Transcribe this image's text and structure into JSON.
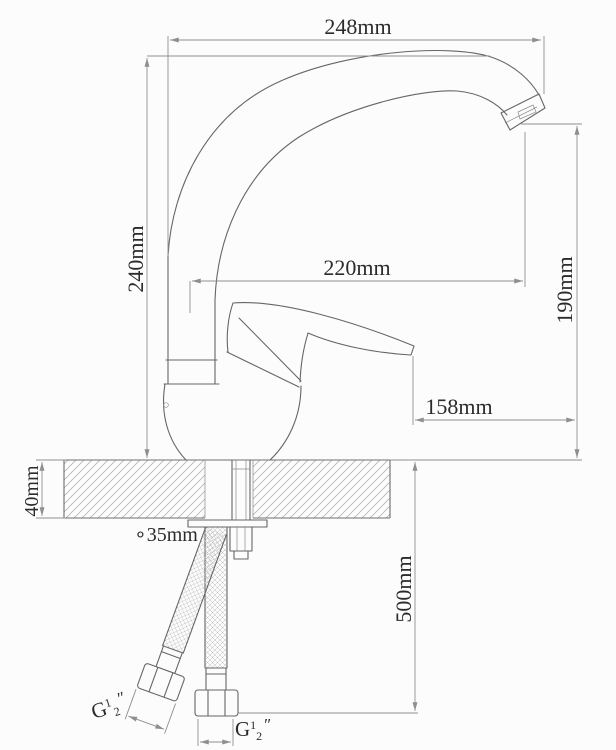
{
  "dims": {
    "spout_width_top": "248mm",
    "overall_height": "240mm",
    "spout_reach": "220mm",
    "outlet_height": "190mm",
    "handle_reach": "158mm",
    "counter_thickness": "40mm",
    "hose_length": "500mm",
    "hole_diameter": "∘35mm"
  },
  "thread_label": {
    "prefix": "G",
    "numerator": "1",
    "denominator": "2",
    "inch_mark": "″"
  },
  "colors": {
    "background": "#fcfcfc",
    "outline": "#666666",
    "dimension_lines": "#8f8f8f",
    "text": "#2b2b2b",
    "hatch": "#a8a8a8"
  }
}
